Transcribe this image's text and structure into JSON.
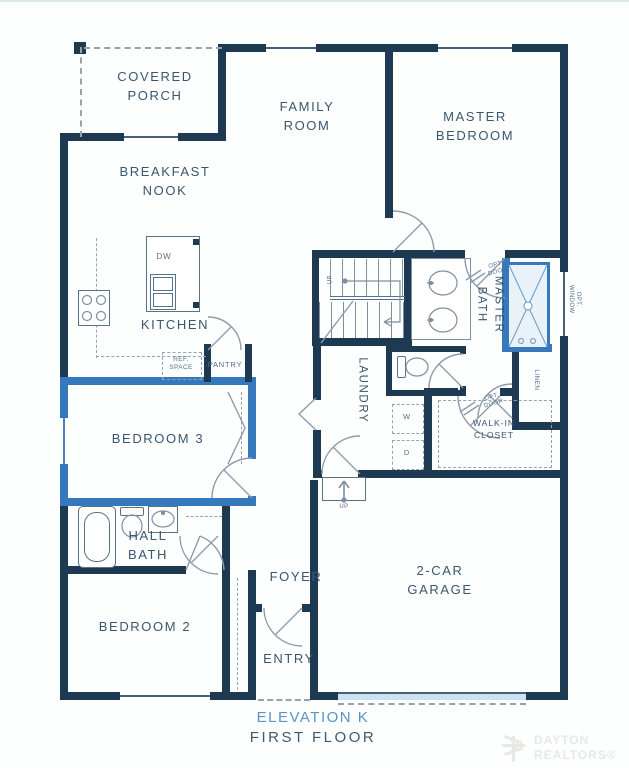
{
  "colors": {
    "wall_navy": "#1e3a53",
    "accent_blue": "#3578bc",
    "garage_sill_blue": "#cfe0ee",
    "title_blue": "#5795c8",
    "text_navy": "#3a5670",
    "watermark_gray": "#e8e8e5"
  },
  "rooms": {
    "covered_porch": "COVERED\nPORCH",
    "family_room": "FAMILY\nROOM",
    "master_bedroom": "MASTER\nBEDROOM",
    "breakfast_nook": "BREAKFAST\nNOOK",
    "kitchen": "KITCHEN",
    "master_bath": "MASTER\nBATH",
    "laundry": "LAUNDRY",
    "walk_in_closet": "WALK-IN\nCLOSET",
    "bedroom_3": "BEDROOM 3",
    "hall_bath": "HALL\nBATH",
    "bedroom_2": "BEDROOM 2",
    "foyer": "FOYER",
    "entry": "ENTRY",
    "garage": "2-CAR\nGARAGE"
  },
  "fixtures": {
    "dw": "DW",
    "ref_space": "REF.\nSPACE",
    "pantry": "PANTRY",
    "linen": "LINEN",
    "washer": "W",
    "dryer": "D",
    "stairs_up": "UP",
    "garage_step_up": "UP",
    "opt_door_bath": "OPT.\nDOOR",
    "opt_door_closet": "OPT.\nDOOR",
    "opt_window": "OPT.\nWINDOW"
  },
  "footer": {
    "elevation": "ELEVATION K",
    "floor": "FIRST FLOOR"
  },
  "watermark": {
    "text": "DAYTON\nREALTORS®"
  }
}
